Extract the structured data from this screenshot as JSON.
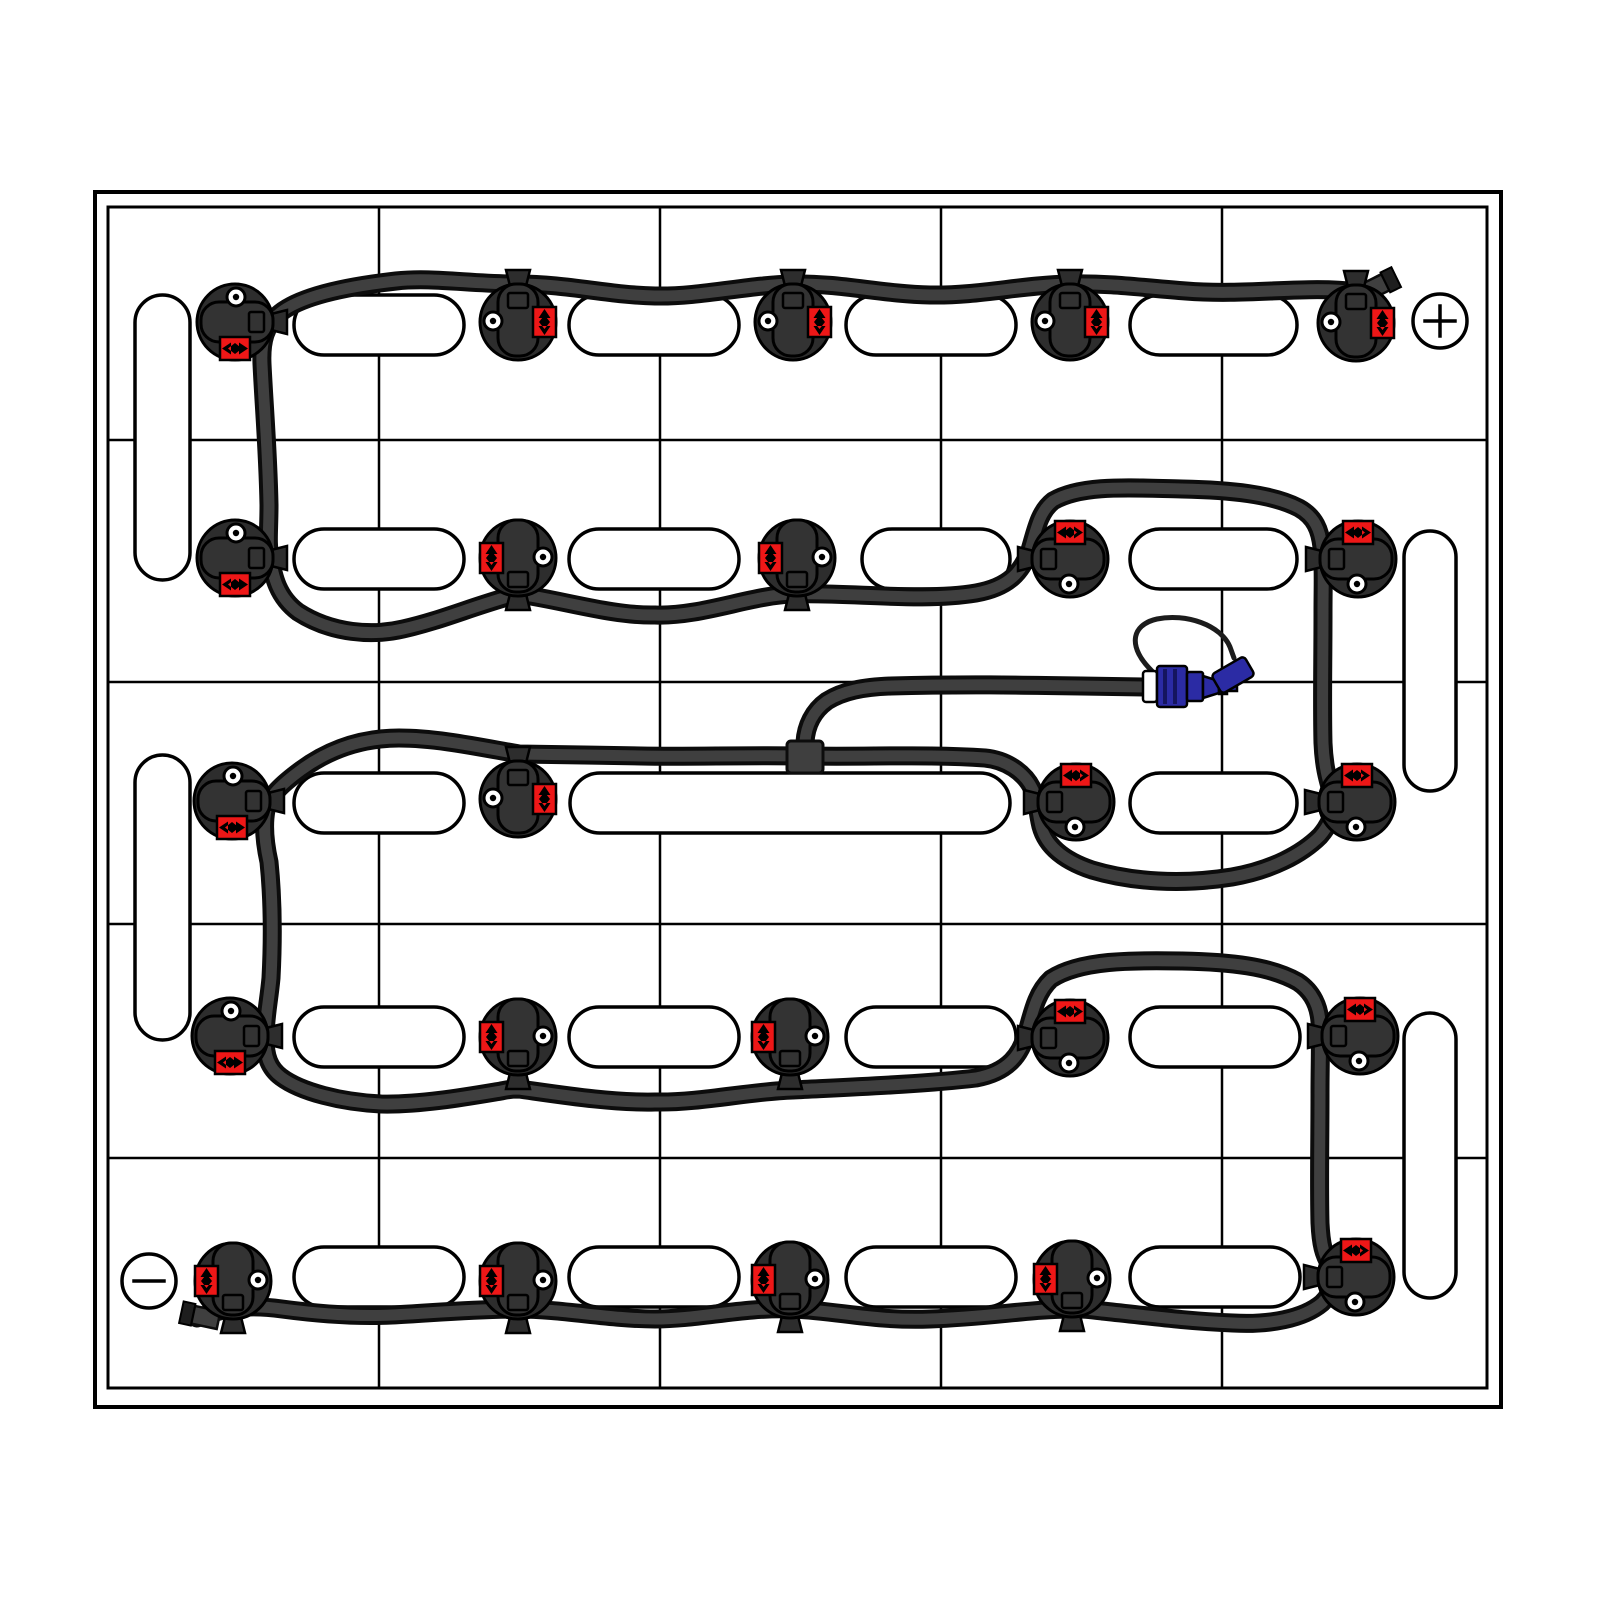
{
  "app": {
    "description": "Battery watering system installation diagram",
    "canvas": {
      "width": 1600,
      "height": 1600
    }
  },
  "colors": {
    "background": "#ffffff",
    "line": "#000000",
    "cell_fill": "#ffffff",
    "tube_outline": "#0c0c0c",
    "tube_core": "#3f3f3f",
    "valve_body": "#2d2d2d",
    "valve_cap": "#333333",
    "indicator_red": "#ee1717",
    "coupler_blue": "#2b2ba4",
    "coupler_ridge": "#15155e",
    "plug_dark": "#1e1e1e",
    "white": "#ffffff"
  },
  "battery_bank": {
    "outer_rect": {
      "x": 95,
      "y": 192,
      "w": 1406,
      "h": 1215,
      "stroke_w": 4
    },
    "inner_rect": {
      "x": 108,
      "y": 207,
      "w": 1379,
      "h": 1181,
      "stroke_w": 3
    },
    "v_lines": [
      379,
      660,
      941,
      1222
    ],
    "h_lines": [
      440,
      682,
      924,
      1158
    ],
    "grid_stroke_w": 2.5
  },
  "cell_vents": {
    "horizontal_pills": [
      {
        "x": 294,
        "y": 295,
        "w": 170,
        "h": 60
      },
      {
        "x": 569,
        "y": 295,
        "w": 170,
        "h": 60
      },
      {
        "x": 846,
        "y": 295,
        "w": 170,
        "h": 60
      },
      {
        "x": 1130,
        "y": 295,
        "w": 167,
        "h": 60
      },
      {
        "x": 294,
        "y": 529,
        "w": 170,
        "h": 60
      },
      {
        "x": 569,
        "y": 529,
        "w": 170,
        "h": 60
      },
      {
        "x": 862,
        "y": 529,
        "w": 148,
        "h": 60
      },
      {
        "x": 1130,
        "y": 529,
        "w": 167,
        "h": 60
      },
      {
        "x": 294,
        "y": 773,
        "w": 170,
        "h": 60
      },
      {
        "x": 570,
        "y": 773,
        "w": 440,
        "h": 60
      },
      {
        "x": 1130,
        "y": 773,
        "w": 167,
        "h": 60
      },
      {
        "x": 294,
        "y": 1007,
        "w": 170,
        "h": 60
      },
      {
        "x": 569,
        "y": 1007,
        "w": 170,
        "h": 60
      },
      {
        "x": 846,
        "y": 1007,
        "w": 170,
        "h": 60
      },
      {
        "x": 1130,
        "y": 1007,
        "w": 170,
        "h": 60
      },
      {
        "x": 294,
        "y": 1247,
        "w": 170,
        "h": 60
      },
      {
        "x": 569,
        "y": 1247,
        "w": 170,
        "h": 60
      },
      {
        "x": 846,
        "y": 1247,
        "w": 170,
        "h": 60
      },
      {
        "x": 1130,
        "y": 1247,
        "w": 170,
        "h": 60
      }
    ],
    "vertical_pills": [
      {
        "x": 135,
        "y": 295,
        "w": 55,
        "h": 285
      },
      {
        "x": 135,
        "y": 755,
        "w": 55,
        "h": 285
      },
      {
        "x": 1404,
        "y": 531,
        "w": 52,
        "h": 260
      },
      {
        "x": 1404,
        "y": 1013,
        "w": 52,
        "h": 285
      }
    ],
    "pill_stroke_w": 3.5
  },
  "terminals": {
    "positive": {
      "symbol": "+",
      "x": 1440,
      "y": 321,
      "r": 27,
      "stroke_w": 3.5
    },
    "negative": {
      "symbol": "-",
      "x": 149,
      "y": 1281,
      "r": 27,
      "stroke_w": 3.5
    }
  },
  "valves": {
    "radius": 38,
    "items": [
      {
        "id": "row1-valve1",
        "x": 235,
        "y": 322,
        "t": "rotate(90)",
        "tab": 90
      },
      {
        "id": "row1-valve2",
        "x": 518,
        "y": 322,
        "t": "",
        "tab": 0
      },
      {
        "id": "row1-valve3",
        "x": 793,
        "y": 322,
        "t": "",
        "tab": 0
      },
      {
        "id": "row1-valve4",
        "x": 1070,
        "y": 322,
        "t": "",
        "tab": 0
      },
      {
        "id": "row1-valve5",
        "x": 1356,
        "y": 323,
        "t": "",
        "tab": 0
      },
      {
        "id": "row2-valve1",
        "x": 235,
        "y": 558,
        "t": "rotate(90)",
        "tab": 90
      },
      {
        "id": "row2-valve2",
        "x": 518,
        "y": 558,
        "t": "scale(-1,1)",
        "tab": 180
      },
      {
        "id": "row2-valve3",
        "x": 797,
        "y": 558,
        "t": "scale(-1,1)",
        "tab": 180
      },
      {
        "id": "row2-valve4",
        "x": 1070,
        "y": 559,
        "t": "rotate(-90)",
        "tab": 270
      },
      {
        "id": "row2-valve5",
        "x": 1358,
        "y": 559,
        "t": "rotate(-90)",
        "tab": 270
      },
      {
        "id": "row3-valve1",
        "x": 232,
        "y": 801,
        "t": "rotate(90)",
        "tab": 90
      },
      {
        "id": "row3-valve2",
        "x": 518,
        "y": 799,
        "t": "",
        "tab": 0
      },
      {
        "id": "row3-valve3",
        "x": 1076,
        "y": 802,
        "t": "rotate(-90)",
        "tab": 270
      },
      {
        "id": "row3-valve4",
        "x": 1357,
        "y": 802,
        "t": "rotate(-90)",
        "tab": 270
      },
      {
        "id": "row4-valve1",
        "x": 230,
        "y": 1036,
        "t": "rotate(90)",
        "tab": 90
      },
      {
        "id": "row4-valve2",
        "x": 518,
        "y": 1037,
        "t": "scale(-1,1)",
        "tab": 180
      },
      {
        "id": "row4-valve3",
        "x": 790,
        "y": 1037,
        "t": "scale(-1,1)",
        "tab": 180
      },
      {
        "id": "row4-valve4",
        "x": 1070,
        "y": 1038,
        "t": "rotate(-90)",
        "tab": 270
      },
      {
        "id": "row4-valve5",
        "x": 1360,
        "y": 1036,
        "t": "rotate(-90)",
        "tab": 270
      },
      {
        "id": "row5-valve1",
        "x": 233,
        "y": 1281,
        "t": "scale(-1,1)",
        "tab": 180
      },
      {
        "id": "row5-valve2",
        "x": 518,
        "y": 1281,
        "t": "scale(-1,1)",
        "tab": 180
      },
      {
        "id": "row5-valve3",
        "x": 790,
        "y": 1280,
        "t": "scale(-1,1)",
        "tab": 180
      },
      {
        "id": "row5-valve4",
        "x": 1072,
        "y": 1279,
        "t": "scale(-1,1)",
        "tab": 180
      },
      {
        "id": "row5-valve5",
        "x": 1356,
        "y": 1277,
        "t": "rotate(-90)",
        "tab": 270
      }
    ]
  },
  "tubing": {
    "outline_w": 19,
    "core_w": 11,
    "main_path": "M 1384 282 C 1372 288 1366 293 1356 292 C 1310 285 1248 296 1186 291 C 1144 288 1112 283 1070 284 C 1022 285 978 296 930 295 C 882 294 840 283 793 284 C 748 285 700 297 655 296 C 608 295 568 284 518 284 C 470 284 432 277 396 281 C 342 287 300 297 280 313 C 265 325 261 342 262 364 C 264 406 268 452 269 505 C 269 530 267 544 270 556 C 273 577 278 597 298 612 C 332 634 373 636 403 629 C 443 620 473 606 518 594 C 562 600 612 616 655 615 C 700 617 752 595 793 594 C 850 592 922 602 976 593 C 1010 587 1022 571 1030 550 C 1036 530 1039 512 1053 501 C 1082 484 1132 488 1182 489 C 1230 490 1272 494 1299 508 C 1315 517 1320 530 1322 547 C 1324 563 1323 583 1323 613 C 1323 663 1322 703 1323 743 C 1324 767 1328 780 1332 794 C 1336 808 1332 822 1320 836 C 1302 854 1272 870 1232 877 C 1182 885 1132 882 1092 870 C 1062 860 1044 844 1040 822 C 1037 807 1037 797 1032 788 C 1024 772 1006 760 985 758 C 930 754 870 757 806 756 C 742 755 691 757 641 756 C 601 755 557 755 519 754 C 479 747 437 738 399 738 C 363 738 331 748 301 770 C 282 784 269 796 266 810 C 263 826 265 844 269 862 C 273 902 273 940 271 978 C 269 1000 265 1018 265 1038 C 265 1056 269 1068 281 1077 C 301 1092 341 1102 381 1104 C 421 1105 471 1096 501 1091 C 511 1089 513 1089 519 1089 C 562 1095 612 1103 655 1102 C 700 1103 752 1091 793 1090 C 852 1087 926 1084 976 1078 C 1009 1072 1021 1054 1027 1032 C 1033 1010 1037 992 1051 979 C 1080 960 1132 960 1182 961 C 1230 962 1270 966 1298 982 C 1313 992 1319 1007 1320 1022 C 1321 1043 1320 1063 1320 1093 C 1320 1143 1319 1183 1320 1223 C 1321 1245 1324 1255 1330 1265 C 1336 1277 1334 1291 1322 1303 C 1303 1319 1269 1325 1233 1323 C 1183 1321 1142 1315 1102 1311 C 1087 1309 1084 1309 1072 1309 C 1030 1309 990 1317 930 1319 C 872 1321 840 1311 793 1309 C 742 1307 700 1319 655 1319 C 610 1319 562 1309 519 1309 C 472 1309 432 1313 392 1315 C 352 1317 312 1313 282 1309 C 252 1305 232 1307 212 1313 L 197 1318",
    "branch_path": "M 805 742 C 806 726 813 711 827 701 C 843 691 863 687 891 686 C 961 684 1021 685 1081 686 L 1147 687",
    "t_fitting": {
      "x": 787,
      "y": 741,
      "w": 36,
      "h": 32
    },
    "end_plug_positive": {
      "x": 1380,
      "y": 285,
      "angle": -26
    },
    "end_plug_negative": {
      "x": 199,
      "y": 1316,
      "angle": 12
    }
  },
  "coupler": {
    "white_ring": {
      "x": 1143,
      "y": 671,
      "w": 14,
      "h": 31
    },
    "body": {
      "x": 1157,
      "y": 666,
      "w": 30,
      "h": 41
    },
    "ridges": [
      1163,
      1173
    ],
    "step": {
      "x": 1187,
      "y": 672,
      "w": 16,
      "h": 29
    },
    "taper": "M 1203 676 L 1219 681 L 1219 693 L 1203 698 Z",
    "tip1": {
      "x": 1219,
      "y": 680,
      "w": 8,
      "h": 14
    },
    "tip2": {
      "x": 1227,
      "y": 683,
      "w": 10,
      "h": 8
    },
    "lanyard_path": "M 1152 671 C 1128 648 1130 625 1157 619 C 1186 613 1221 625 1230 647 L 1234 658",
    "dust_cap": {
      "x": 1233,
      "y": 675,
      "w": 38,
      "h": 22,
      "angle": -30
    }
  }
}
